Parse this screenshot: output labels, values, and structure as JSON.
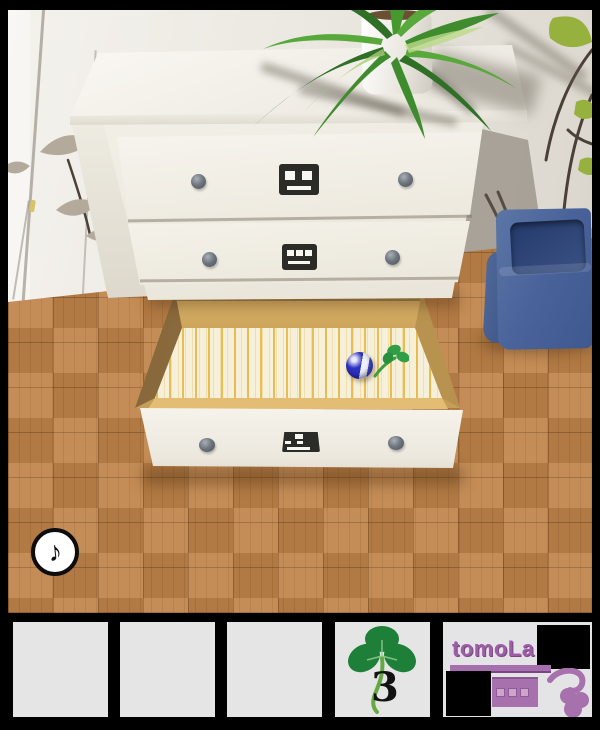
{
  "scene": {
    "music_button": {
      "symbol": "♪",
      "icon": "music-note-icon"
    },
    "dresser": {
      "drawer_top_icon": "face-two-eyes",
      "drawer_middle_icon": "face-three-eyes",
      "drawer_bottom_icon": "face-tilted",
      "open_drawer": "bottom",
      "drawer_items": [
        "blue marble",
        "clover sprout"
      ]
    },
    "objects": [
      "potted plant",
      "blue wastebasket",
      "wall leaf decals",
      "parquet floor"
    ]
  },
  "inventory": {
    "slot_count": 5,
    "slots": [
      {
        "id": 1,
        "content": ""
      },
      {
        "id": 2,
        "content": ""
      },
      {
        "id": 3,
        "content": ""
      },
      {
        "id": 4,
        "content": "clover",
        "count": "3"
      },
      {
        "id": 5,
        "content": "logo"
      }
    ]
  },
  "logo": {
    "title": "tomoLa",
    "color": "#9c5fa6"
  },
  "colors": {
    "wall": "#eae7e0",
    "floor": "#c08349",
    "dresser": "#f2efe7",
    "drawer_wood": "#c79e58",
    "paper_stripe": "#eecf6e",
    "marble_blue": "#2a2fb8",
    "clover_green": "#1f8a3a",
    "bin_blue": "#4a639b",
    "slot_gray": "#e5e5e5",
    "logo_purple": "#a66fad"
  }
}
